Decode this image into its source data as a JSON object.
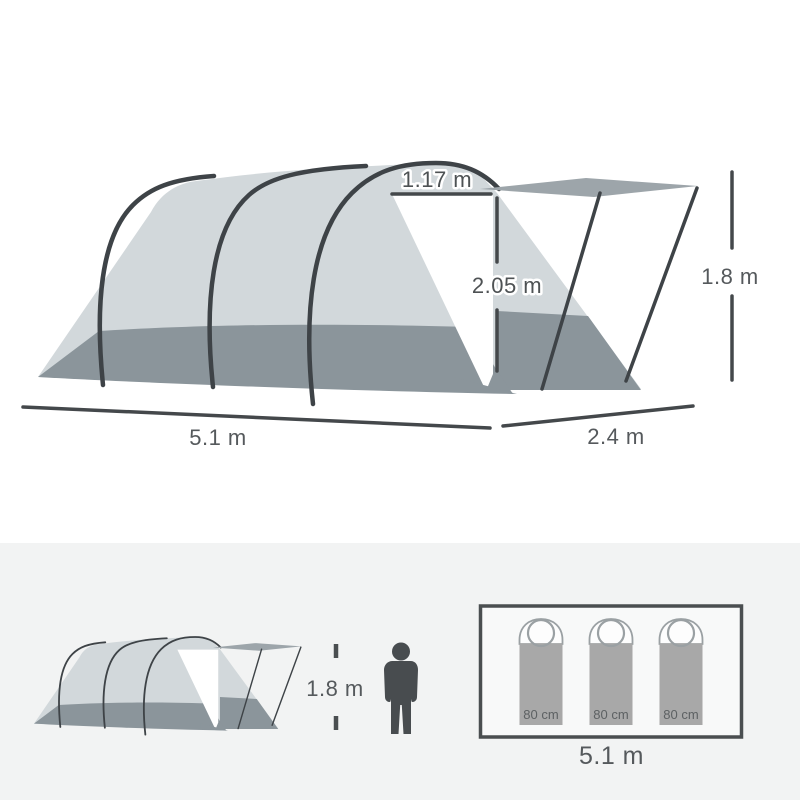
{
  "main_diagram": {
    "dimensions": {
      "door_top_width": "1.17 m",
      "door_height": "2.05 m",
      "awning_height": "1.8 m",
      "tent_length": "5.1 m",
      "awning_depth": "2.4 m"
    }
  },
  "scale_panel": {
    "person_height": "1.8 m",
    "floor_plan": {
      "sleeping_bags": [
        {
          "width_label": "80 cm"
        },
        {
          "width_label": "80 cm"
        },
        {
          "width_label": "80 cm"
        }
      ],
      "interior_length": "5.1 m"
    }
  },
  "colors": {
    "background": "#ffffff",
    "panel_background": "#f2f3f3",
    "tent_fabric": "#d2d8db",
    "tent_base_band": "#8b959b",
    "awning_roof": "#9da5aa",
    "pole_lines": "#3e4347",
    "dimension_text": "#4e5254",
    "figure_and_frame": "#484c4f",
    "sleeping_bag_fill": "#a8a8a8"
  }
}
